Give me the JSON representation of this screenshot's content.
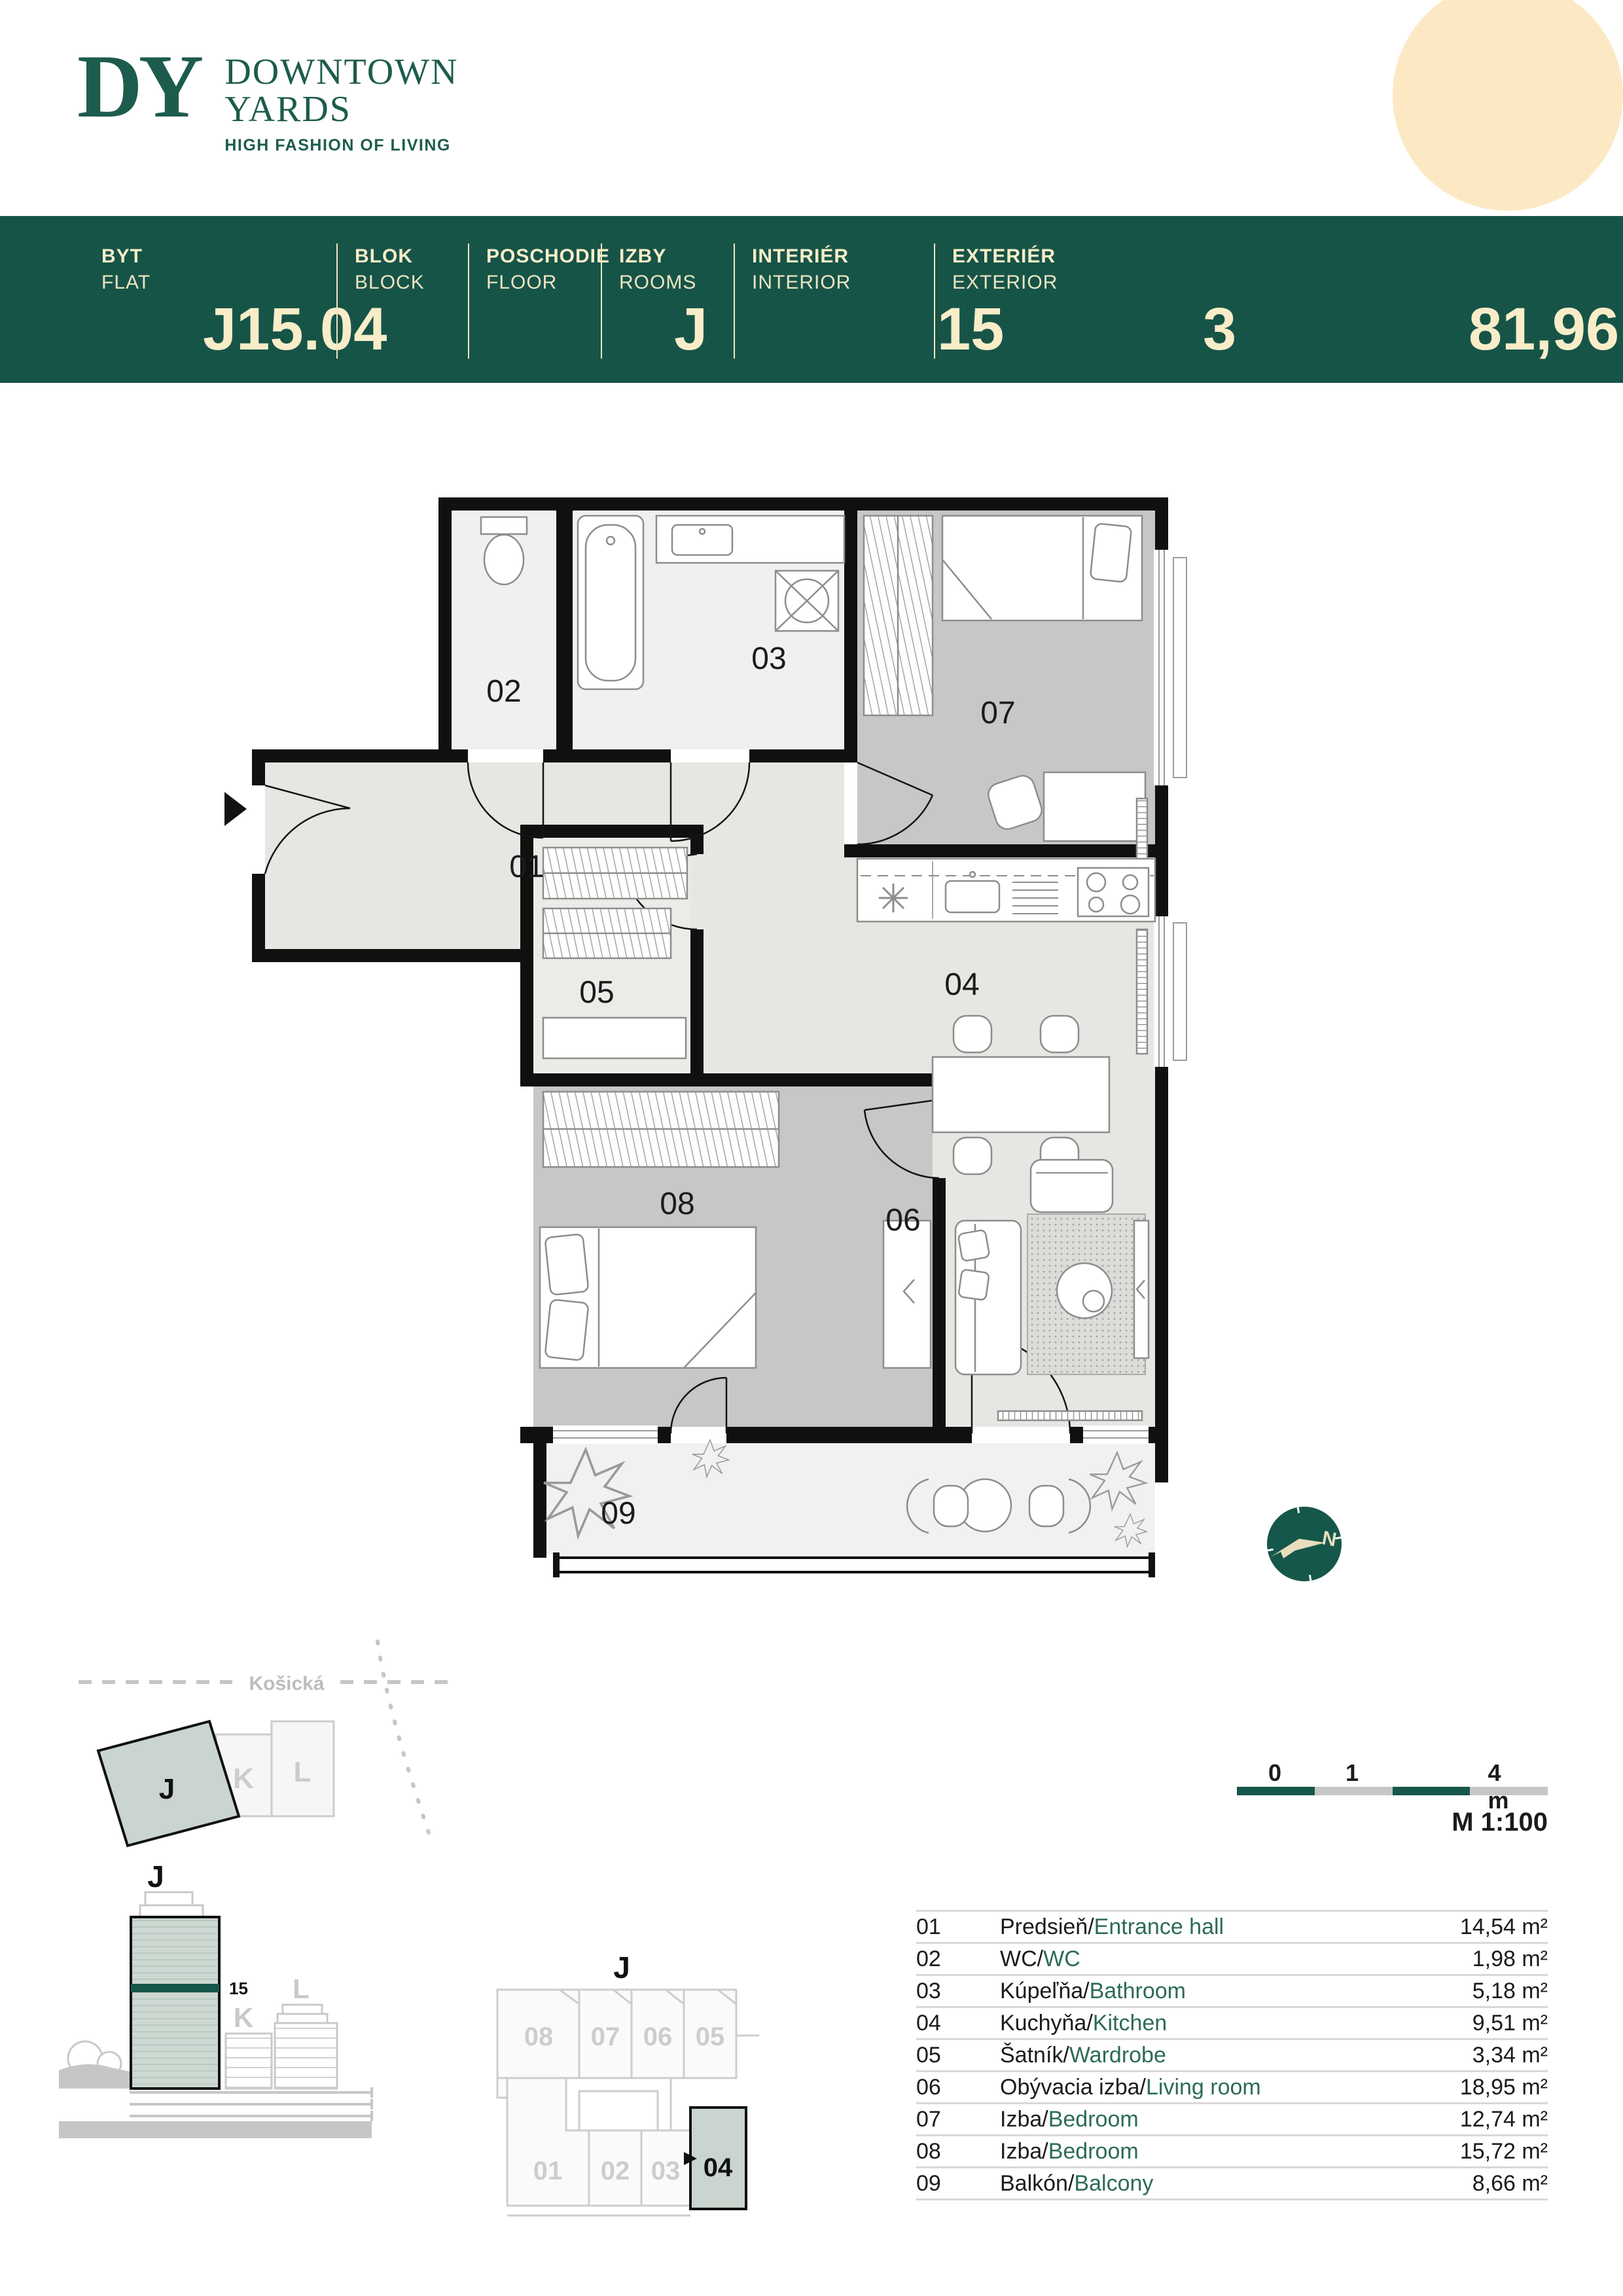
{
  "logo": {
    "monogram": "DY",
    "line1": "DOWNTOWN",
    "line2": "YARDS",
    "tagline": "HIGH FASHION OF LIVING"
  },
  "header": {
    "cols": [
      {
        "label_sk": "BYT",
        "label_en": "FLAT",
        "value": "J15.04"
      },
      {
        "label_sk": "BLOK",
        "label_en": "BLOCK",
        "value": "J"
      },
      {
        "label_sk": "POSCHODIE",
        "label_en": "FLOOR",
        "value": "15"
      },
      {
        "label_sk": "IZBY",
        "label_en": "ROOMS",
        "value": "3"
      },
      {
        "label_sk": "INTERIÉR",
        "label_en": "INTERIOR",
        "value": "81,96m²"
      },
      {
        "label_sk": "EXTERIÉR",
        "label_en": "EXTERIOR",
        "value": "8,66m²"
      }
    ]
  },
  "plan": {
    "labels": {
      "r01": "01",
      "r02": "02",
      "r03": "03",
      "r04": "04",
      "r05": "05",
      "r06": "06",
      "r07": "07",
      "r08": "08",
      "r09": "09"
    }
  },
  "compass": {
    "north": "N"
  },
  "scalebar": {
    "t0": "0",
    "t1": "1",
    "t4": "4 m",
    "scale_text": "M 1:100"
  },
  "siteplan": {
    "street": "Košická",
    "block_j": "J",
    "block_k": "K",
    "block_l": "L"
  },
  "elevation": {
    "block_j": "J",
    "block_k": "K",
    "block_l": "L",
    "floor": "15"
  },
  "keyplan": {
    "title": "J",
    "top": [
      "08",
      "07",
      "06",
      "05"
    ],
    "bottom": [
      "01",
      "02",
      "03",
      "04"
    ]
  },
  "legend": {
    "rows": [
      {
        "num": "01",
        "sk": "Predsieň",
        "slash": "/",
        "en": "Entrance hall",
        "area": "14,54 m²"
      },
      {
        "num": "02",
        "sk": "WC",
        "slash": "/",
        "en": "WC",
        "area": "1,98 m²"
      },
      {
        "num": "03",
        "sk": "Kúpeľňa",
        "slash": "/",
        "en": "Bathroom",
        "area": "5,18 m²"
      },
      {
        "num": "04",
        "sk": "Kuchyňa",
        "slash": "/",
        "en": "Kitchen",
        "area": "9,51 m²"
      },
      {
        "num": "05",
        "sk": "Šatník",
        "slash": "/",
        "en": "Wardrobe",
        "area": "3,34 m²"
      },
      {
        "num": "06",
        "sk": "Obývacia izba",
        "slash": "/",
        "en": "Living room",
        "area": "18,95 m²"
      },
      {
        "num": "07",
        "sk": "Izba",
        "slash": "/",
        "en": "Bedroom",
        "area": "12,74 m²"
      },
      {
        "num": "08",
        "sk": "Izba",
        "slash": "/",
        "en": "Bedroom",
        "area": "15,72 m²"
      },
      {
        "num": "09",
        "sk": "Balkón",
        "slash": "/",
        "en": "Balcony",
        "area": "8,66 m²"
      }
    ]
  },
  "colors": {
    "header_green": "#175448",
    "cream": "#f8edc8",
    "circle": "#fce9c4",
    "accent_green": "#2c6b58",
    "sage": "#c9d5ce",
    "floor_gray": "#e6e6e3",
    "room_gray": "#c7c7c7"
  }
}
